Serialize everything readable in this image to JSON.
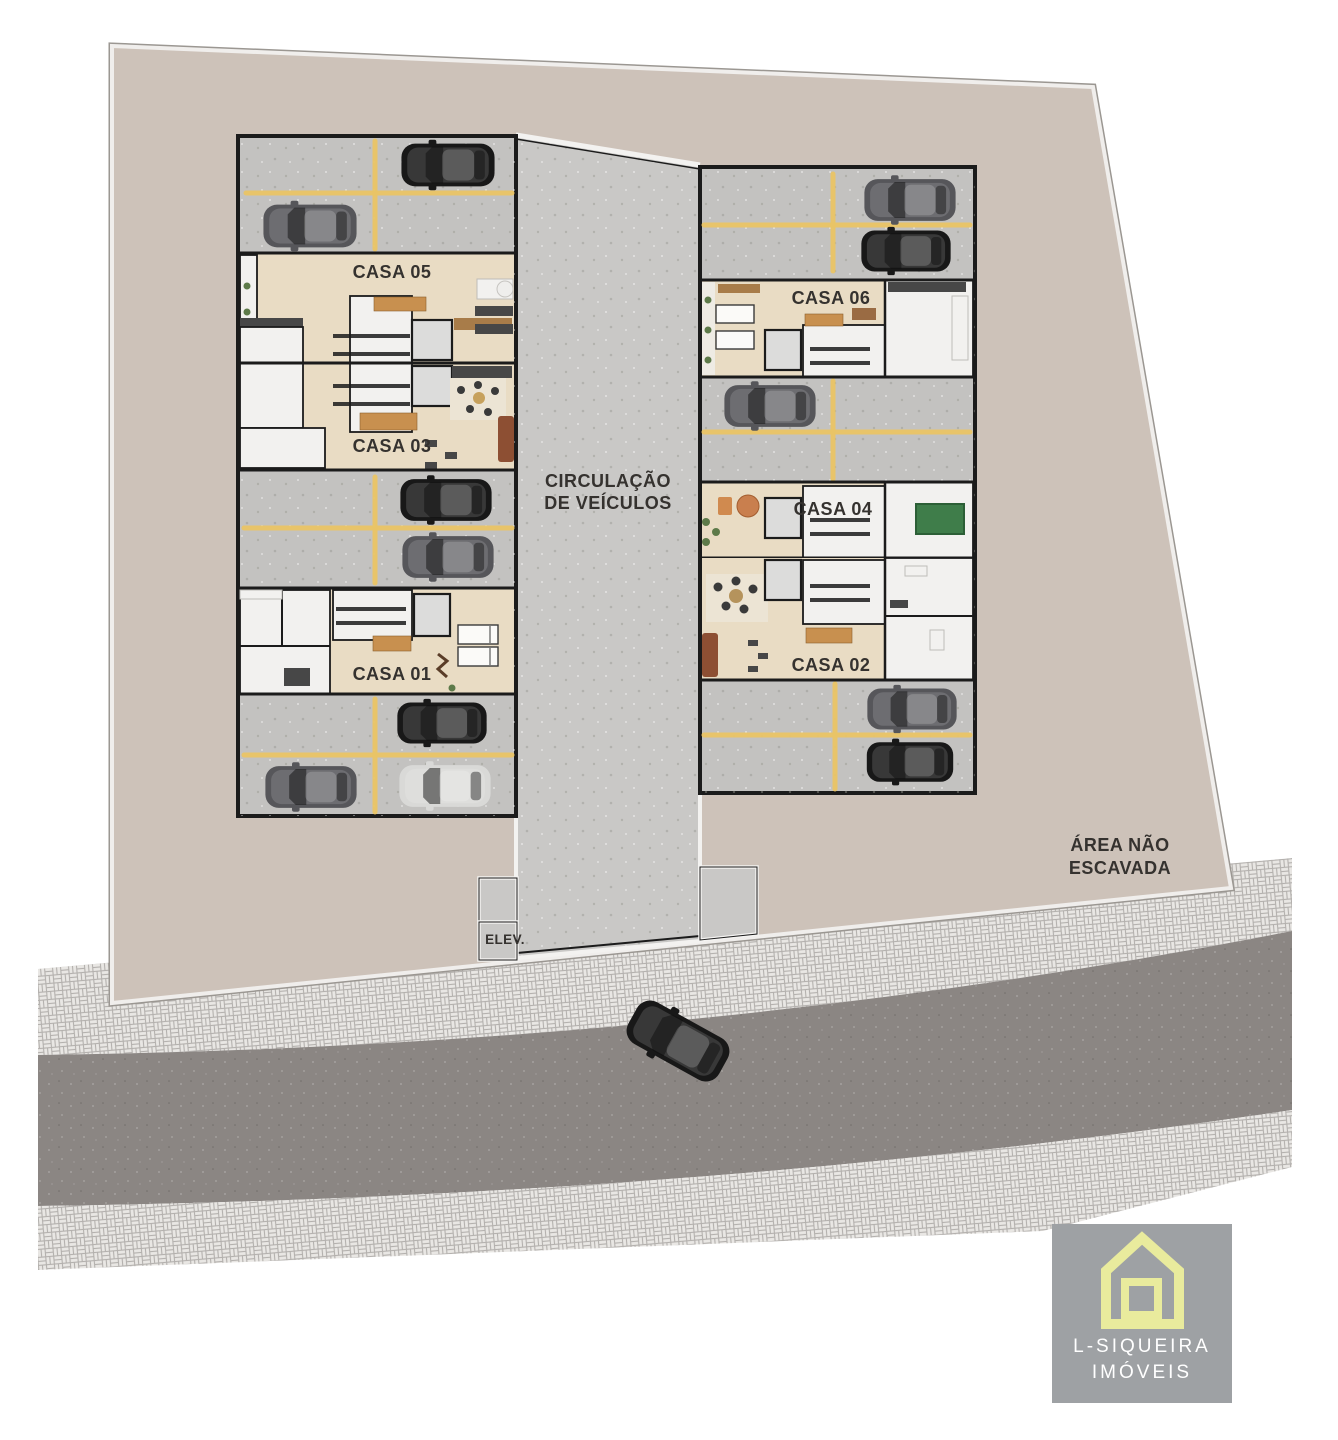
{
  "plan": {
    "houses": [
      {
        "label": "CASA 05"
      },
      {
        "label": "CASA 03"
      },
      {
        "label": "CASA 01"
      },
      {
        "label": "CASA 06"
      },
      {
        "label": "CASA 04"
      },
      {
        "label": "CASA 02"
      }
    ],
    "circulation": {
      "line1": "CIRCULAÇÃO",
      "line2": "DE VEÍCULOS"
    },
    "elevator": {
      "label": "ELEV."
    },
    "unexcavated": {
      "line1": "ÁREA NÃO",
      "line2": "ESCAVADA"
    }
  },
  "logo": {
    "name_line1": "L-SIQUEIRA",
    "name_line2": "IMÓVEIS"
  },
  "icons": {
    "car": "car-top-view-icon",
    "logo_mark": "house-outline-icon"
  },
  "colors": {
    "white": "#ffffff",
    "plot": "#cdc2b9",
    "plot_border_light": "#f0eeec",
    "plot_border_dark": "#9b9792",
    "concrete": "#c3c2c0",
    "circulation": "#c9c8c6",
    "wood": "#e9dcc4",
    "room": "#f2f1ef",
    "wall": "#1b1b1b",
    "parking_line": "#eac566",
    "road": "#8b8683",
    "label_text": "#35322f",
    "car_black": "#181818",
    "car_gray": "#56565a",
    "car_silver": "#d9d9d7",
    "logo_bg": "#9ea1a4",
    "logo_accent": "#e9eb9d",
    "logo_text": "#ffffff",
    "cabinet_orange": "#c8904f",
    "sofa_brown": "#8d4f33",
    "rug": "#ece4d4",
    "plant_green": "#5d7a49",
    "pool_green": "#3f7d4a",
    "appliance_dark": "#474747",
    "elevator": "#dcdcdb"
  }
}
